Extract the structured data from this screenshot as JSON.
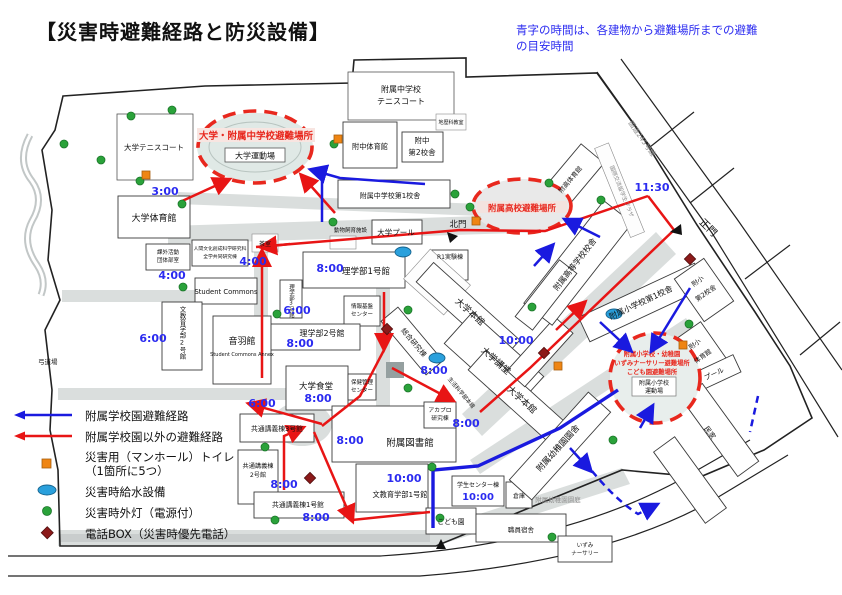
{
  "title": "【災害時避難経路と防災設備】",
  "note": {
    "line1": "青字の時間は、各建物から避難場所までの避難",
    "line2": "の目安時間"
  },
  "legend": {
    "route_school": "附属学校園避難経路",
    "route_other": "附属学校園以外の避難経路",
    "toilet_l1": "災害用（マンホール）トイレ",
    "toilet_l2": "（1箇所に5つ）",
    "water": "災害時給水設備",
    "light": "災害時外灯（電源付）",
    "phone": "電話BOX（災害時優先電話）"
  },
  "colors": {
    "route_blue": "#1a1adf",
    "route_red": "#e81515",
    "evac_red": "#e8281e",
    "time_blue": "#2b2bf0",
    "toilet_orange": "#ef8513",
    "water_blue": "#2aa0dc",
    "light_green": "#2aa23a",
    "phone_darkred": "#8c1a1a"
  },
  "areas": {
    "univ_junior": {
      "label": "大学・附属中学校避難場所",
      "sub": "大学運動場"
    },
    "high_school": {
      "label": "附属高校避難場所"
    },
    "elem": {
      "l1": "附属小学校・幼稚園",
      "l2": "いずみナーサリー避難場所",
      "l3": "こども園避難場所",
      "sub1": "附属小学校",
      "sub2": "運動場"
    }
  },
  "labels": {
    "univ_tennis": "大学テニスコート",
    "univ_gym": "大学体育館",
    "jhs_tennis1": "附属中学校",
    "jhs_tennis2": "テニスコート",
    "jhs_gym": "附中体育館",
    "jhs_b2_1": "附中",
    "jhs_b2_2": "第2校舎",
    "jhs_b1": "附属中学校第1校舎",
    "chireki": "地歴科教室",
    "kita_gate": "北門",
    "sei_gate": "正門",
    "road245": "国道245号線",
    "plaza": "国際交流留学生プラザ",
    "koko_gym": "附高体育館",
    "koko": "附属高等学校校舎",
    "animal": "動物飼育施設",
    "univ_pool": "大学プール",
    "r1lab": "R1実験棟",
    "rigaku1": "理学部1号館",
    "rigaku2": "理学部2号館",
    "rigaku3": "理学部3号館",
    "joho1": "情報基盤",
    "joho2": "センター",
    "kagai1": "課外活動",
    "kagai2": "団体部室",
    "ningen1": "人間文化創成科学研究科",
    "ningen2": "全学共同研究棟",
    "chashitsu": "茶室",
    "student_commons": "Student Commons",
    "otowa": "音羽館",
    "otowa_en": "Student Commons Annex",
    "bunkyo2": "文教育学部2号館",
    "kyudo": "弓道場",
    "shokudo": "大学食堂",
    "hoken1": "保健管理",
    "hoken2": "センター",
    "sogo": "総合研究棟",
    "honkan": "大学本館",
    "kodo": "大学講堂",
    "seikatsu": "生活科学部本館",
    "sho1": "附属小学校第1校舎",
    "sho2_1": "附小",
    "sho2_2": "第2校舎",
    "sho_gym1": "附小",
    "sho_gym2": "体育館",
    "sho_pool": "プール",
    "kyotsu3": "共通講義棟3号館",
    "kyotsu2_1": "共通講義棟",
    "kyotsu2_2": "2号館",
    "kyotsu1": "共通講義棟1号館",
    "library": "附属図書館",
    "bunkyo1": "文教育学部1号館",
    "akapro1": "アカプロ",
    "akapro2": "研究棟",
    "gakusei": "学生センター棟",
    "souko": "倉庫",
    "kodomoen": "こども園",
    "shokuin": "職員宿舎",
    "izumi1": "いずみ",
    "izumi2": "ナーサリー",
    "yochien": "附属幼稚園園舎",
    "entei": "附属幼稚園園庭",
    "minka": "民家"
  },
  "times": {
    "gym3": "3:00",
    "ningen4": "4:00",
    "kagai4": "4:00",
    "bunkyo2_6": "6:00",
    "rigaku3_6": "6:00",
    "kyotsu3_6": "6:00",
    "rigaku1_8": "8:00",
    "rigaku2_8": "8:00",
    "sogo8": "8:00",
    "shokudo8": "8:00",
    "akapro8": "8:00",
    "library8": "8:00",
    "kyotsu2_8": "8:00",
    "kyotsu1_8": "8:00",
    "kodo10": "10:00",
    "bunkyo1_10": "10:00",
    "gakusei10": "10:00",
    "gate1130": "11:30"
  }
}
